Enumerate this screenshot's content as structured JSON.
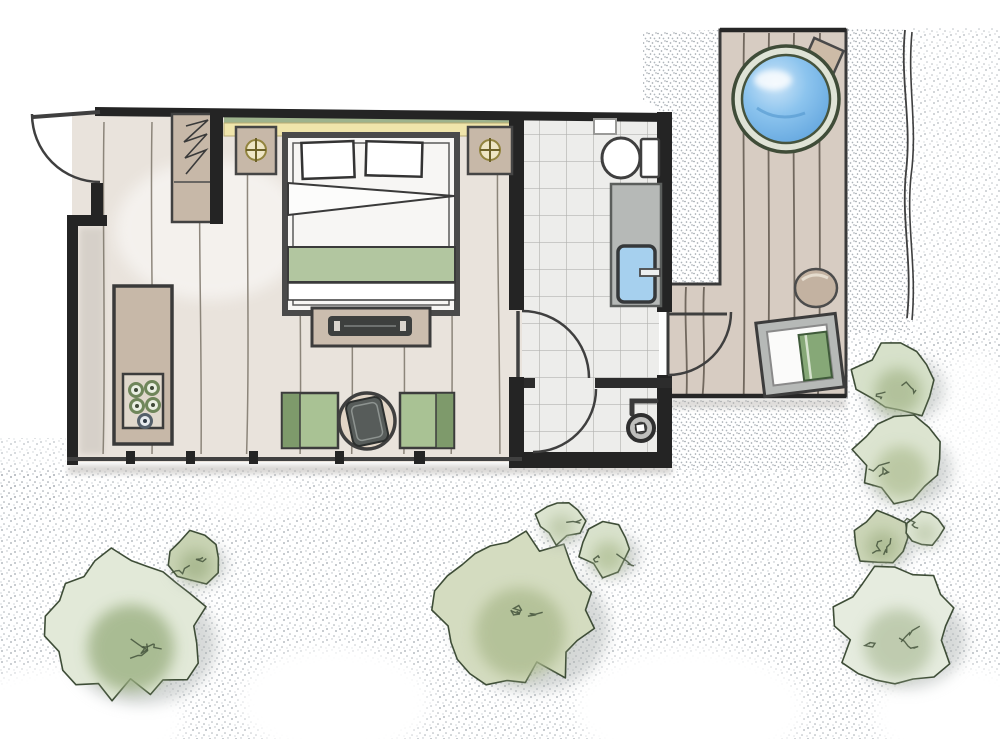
{
  "canvas": {
    "width": 1000,
    "height": 739
  },
  "palette": {
    "ink": "#242424",
    "floor_wood": "#e9e3dc",
    "tile": "#ededeb",
    "deck": "#d7ccc2",
    "strip_green": "#9eb38d",
    "strip_yellow": "#f0e5ab",
    "wood_tan": "#c7b8a8",
    "bed_white": "#f7f6f4",
    "blanket_green": "#b2c6a0",
    "chair_green": "#a9c294",
    "chair_green_dark": "#7e9a6b",
    "table_wood": "#e2d5c6",
    "tray_dark": "#545957",
    "water_blue": "#7eb9e8",
    "tub_rim": "#3f4c38",
    "fixture_gray": "#b6b9b7",
    "sink_blue": "#a6d0ee",
    "pouf_tan": "#c3b2a1",
    "towel_green": "#86a877",
    "stipple_gray": "#9aa1a8"
  },
  "elements": [
    "entry-door",
    "wardrobe",
    "headboard-shelf",
    "nightstand-left",
    "nightstand-right",
    "double-bed",
    "foot-bench",
    "kitchenette-console",
    "armchair-left",
    "armchair-right",
    "coffee-table",
    "bathroom",
    "toilet",
    "flush-plate",
    "vanity",
    "sink",
    "shower-room",
    "grab-bar",
    "floor-drain",
    "deck",
    "hot-tub",
    "tub-step-box",
    "pouf",
    "sun-lounger",
    "fence",
    "gravel",
    "bushes"
  ],
  "planks": {
    "bedroom": {
      "xs": [
        104,
        152,
        200,
        248,
        300,
        352,
        404,
        452,
        498
      ],
      "y1": 122,
      "y2": 454,
      "color": "#7b7468",
      "w": 1.5
    },
    "deck": {
      "xs": [
        744,
        769,
        794,
        820
      ],
      "y1": 33,
      "y2": 394,
      "color": "#5f564c",
      "w": 1.8
    },
    "deck_ext": {
      "xs": [
        686,
        704
      ],
      "y1": 287,
      "y2": 394,
      "color": "#5f564c",
      "w": 1.8
    }
  },
  "bushes": [
    {
      "cx": 127,
      "cy": 626,
      "r": 79,
      "fill": "#e2e9d8",
      "shade": "#9cb183",
      "seed": 11
    },
    {
      "cx": 194,
      "cy": 558,
      "r": 29,
      "fill": "#c9d4b4",
      "shade": "#a3b389",
      "seed": 22
    },
    {
      "cx": 516,
      "cy": 610,
      "r": 82,
      "fill": "#d4dcc0",
      "shade": "#adbc90",
      "seed": 33
    },
    {
      "cx": 560,
      "cy": 521,
      "r": 24,
      "fill": "#dde5d1",
      "shade": "#b9c6a4",
      "seed": 44
    },
    {
      "cx": 607,
      "cy": 549,
      "r": 29,
      "fill": "#d9e2cc",
      "shade": "#b2c198",
      "seed": 55
    },
    {
      "cx": 896,
      "cy": 380,
      "r": 43,
      "fill": "#d7e1ca",
      "shade": "#a9ba90",
      "seed": 66
    },
    {
      "cx": 899,
      "cy": 459,
      "r": 47,
      "fill": "#dce4d0",
      "shade": "#b4c29a",
      "seed": 77
    },
    {
      "cx": 881,
      "cy": 538,
      "r": 30,
      "fill": "#ccd6b8",
      "shade": "#a8b78e",
      "seed": 88
    },
    {
      "cx": 924,
      "cy": 528,
      "r": 19,
      "fill": "#dee6d4",
      "shade": "#bcc8a9",
      "seed": 99
    },
    {
      "cx": 895,
      "cy": 626,
      "r": 63,
      "fill": "#e6ecdf",
      "shade": "#b6c4a4",
      "seed": 110
    }
  ]
}
